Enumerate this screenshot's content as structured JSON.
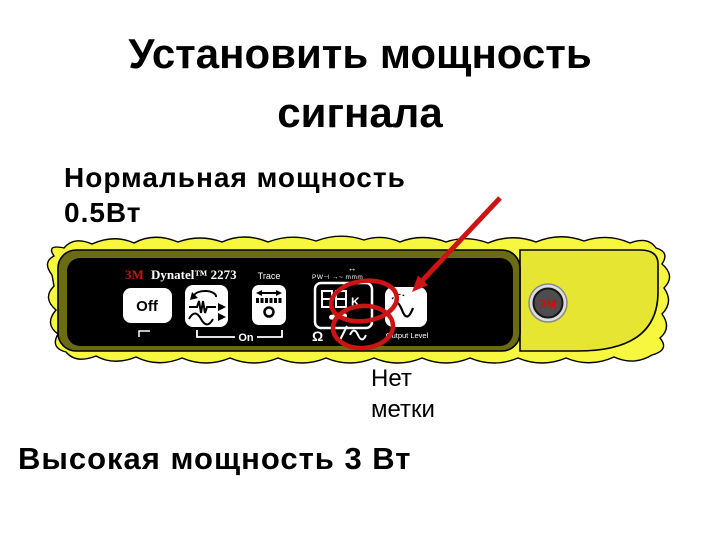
{
  "slide": {
    "title_line1": "Установить мощность",
    "title_line2": "сигнала",
    "normal_power": "Нормальная мощность\n0.5Вт",
    "no_mark": "Нет\nметки",
    "high_power": "Высокая мощность 3 Вт"
  },
  "device": {
    "brand": "3M",
    "model": "Dynatel™ 2273",
    "off": "Off",
    "trace": "Trace",
    "on": "On",
    "ohm": "Ω",
    "k": "K",
    "output_level": "Output Level",
    "tiny_icons": "PW⊣ →~ mmm",
    "width_arrow": "↔",
    "logo": "3M"
  },
  "colors": {
    "blob_yellow": "#f7f73f",
    "device_yellow": "#e6e632",
    "olive_border": "#6b6b16",
    "panel_black": "#000000",
    "annotation_red": "#cc1414",
    "brand_red": "#cc1111"
  }
}
